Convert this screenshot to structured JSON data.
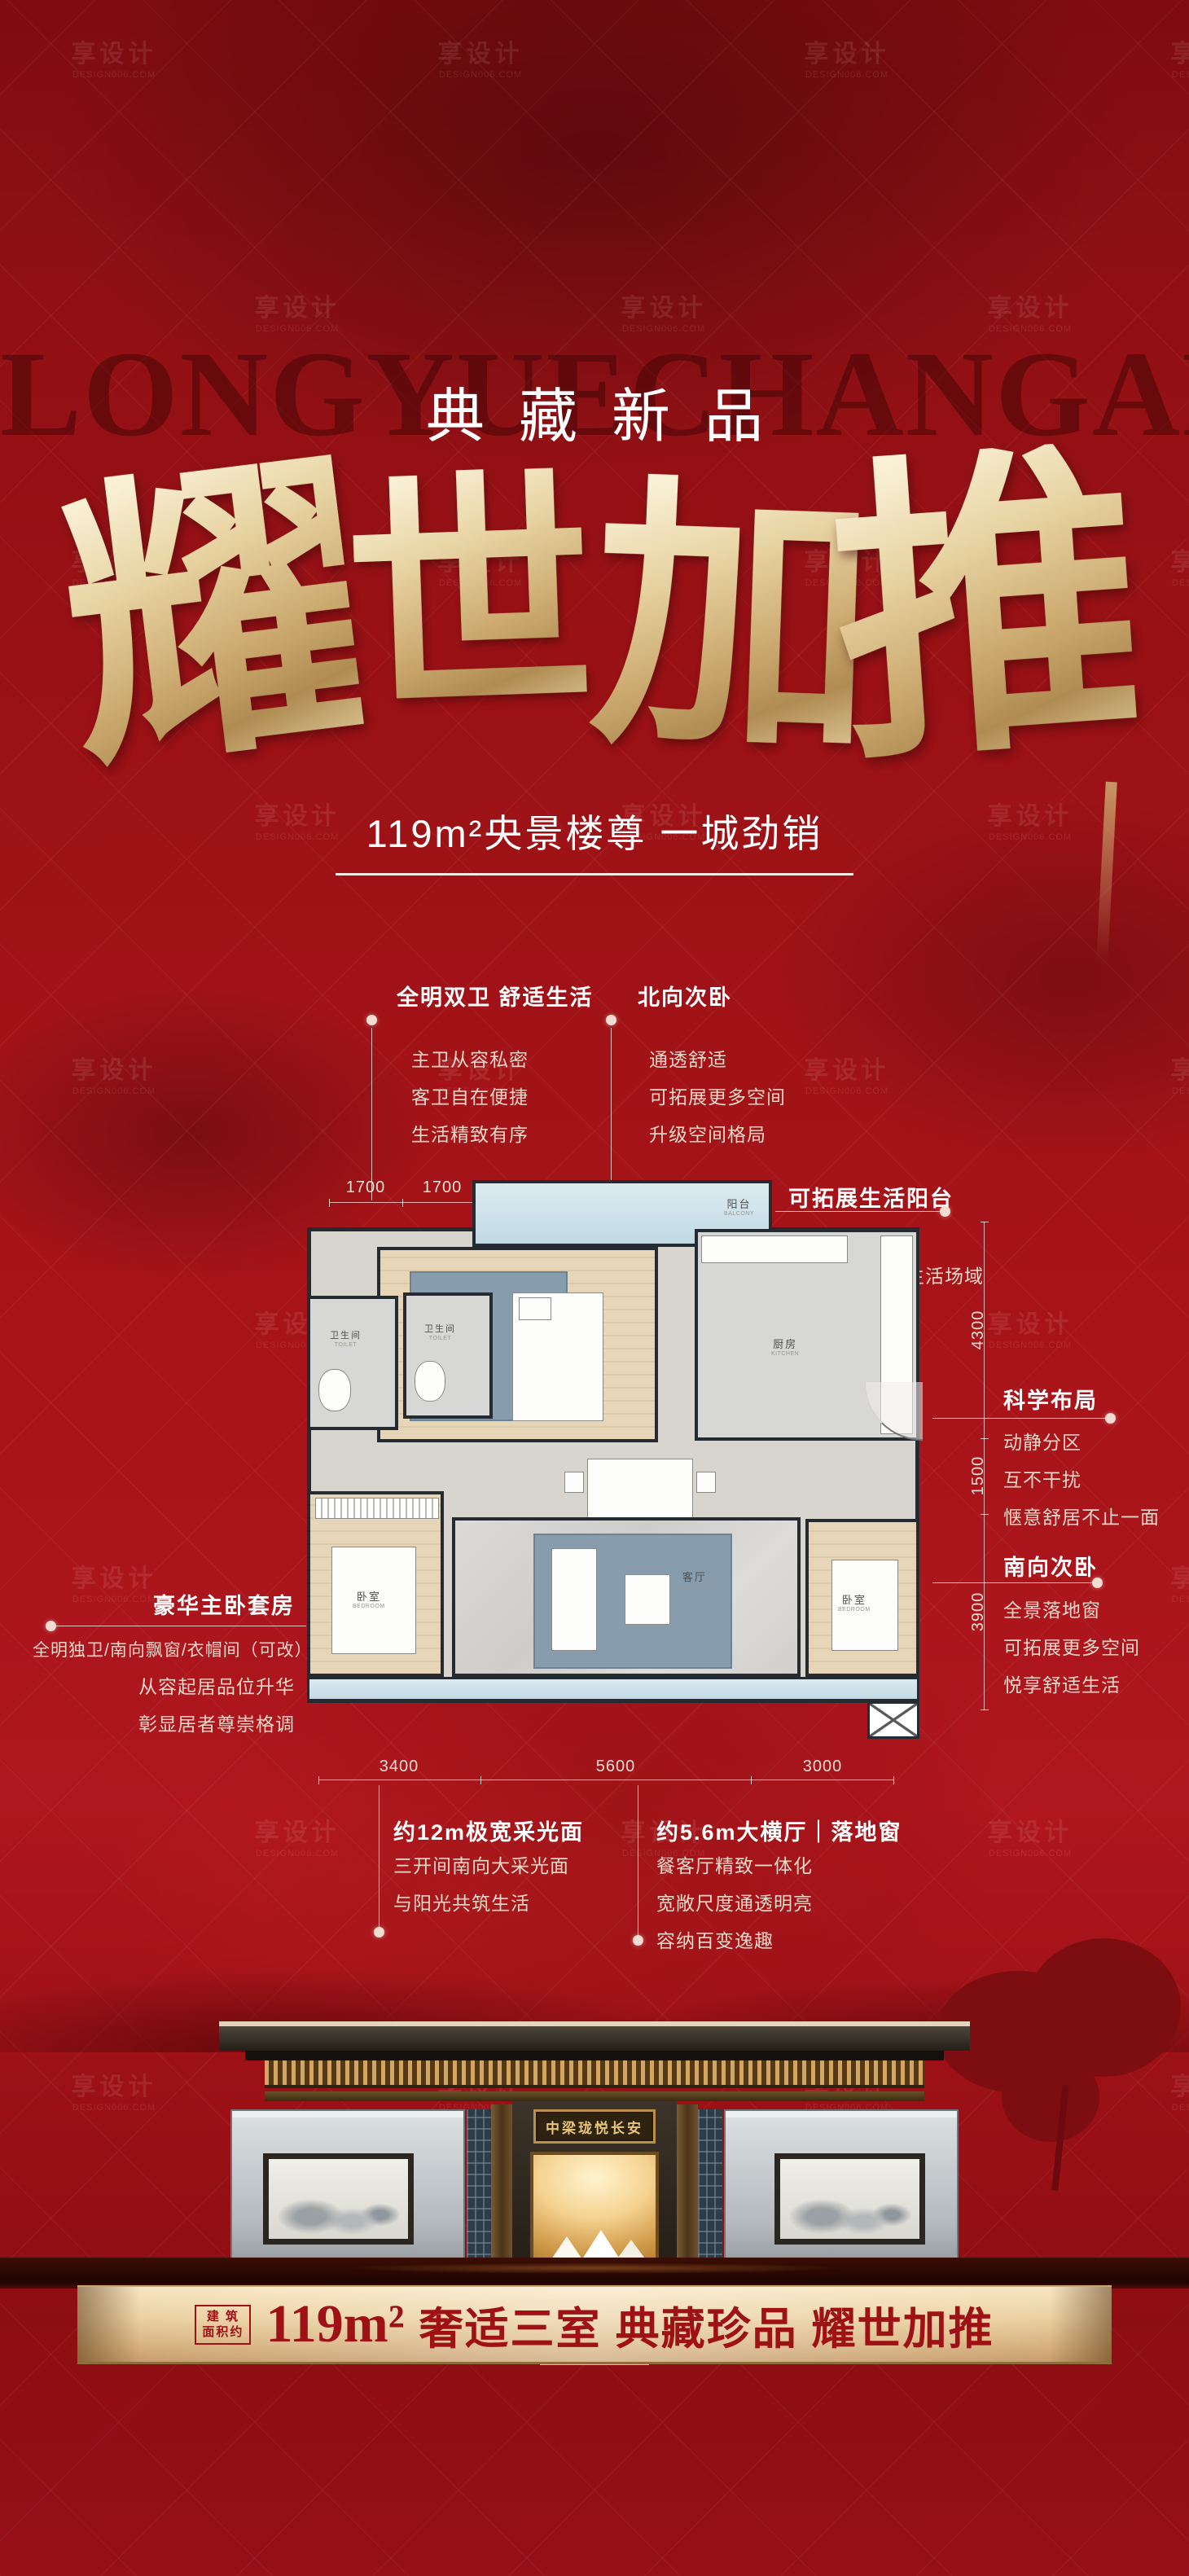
{
  "colors": {
    "background_red": "#9c1115",
    "gold_accent": "#d9bc8c",
    "banner_red_text": "#9e1115",
    "callout_body": "#eed7c8"
  },
  "watermark": {
    "brand": "享设计",
    "site": "DESIGN006.COM"
  },
  "backdrop_text": "LONGYUECHANGAN",
  "header": {
    "kicker": "典藏新品",
    "hero_chars": [
      "耀",
      "世",
      "加",
      "推"
    ],
    "subtitle": "119m²央景楼尊 一城劲销"
  },
  "floorplan": {
    "rooms": {
      "balcony": {
        "zh": "阳台",
        "en": "BALCONY"
      },
      "bedroom_north": {
        "zh": "卧室",
        "en": "BEDROOM"
      },
      "kitchen": {
        "zh": "厨房",
        "en": "KITCHEN"
      },
      "toilet1": {
        "zh": "卫生间",
        "en": "TOILET"
      },
      "toilet2": {
        "zh": "卫生间",
        "en": "TOILET"
      },
      "dining": {
        "zh": "餐厅",
        "en": "DINING ROOM"
      },
      "living": {
        "zh": "客厅",
        "en": "LIVING ROOM"
      },
      "bedroom_master": {
        "zh": "卧室",
        "en": "BEDROOM"
      },
      "bedroom_south": {
        "zh": "卧室",
        "en": "BEDROOM"
      }
    },
    "dims": {
      "top": [
        "1700",
        "1700",
        "3200",
        "2850"
      ],
      "right": [
        "4300",
        "1500",
        "3900"
      ],
      "bottom": [
        "3400",
        "5600",
        "3000"
      ]
    },
    "callouts": {
      "baths": {
        "title": "全明双卫 舒适生活",
        "lines": [
          "主卫从容私密",
          "客卫自在便捷",
          "生活精致有序"
        ]
      },
      "north_bedroom": {
        "title": "北向次卧",
        "lines": [
          "通透舒适",
          "可拓展更多空间",
          "升级空间格局"
        ]
      },
      "balcony": {
        "title": "可拓展生活阳台",
        "lines": [
          "拓展空间尺度",
          "容纳更多居家生活场域"
        ]
      },
      "layout": {
        "title": "科学布局",
        "lines": [
          "动静分区",
          "互不干扰",
          "惬意舒居不止一面"
        ]
      },
      "south_bedroom": {
        "title": "南向次卧",
        "lines": [
          "全景落地窗",
          "可拓展更多空间",
          "悦享舒适生活"
        ]
      },
      "master": {
        "title": "豪华主卧套房",
        "lines": [
          "全明独卫/南向飘窗/衣帽间（可改）",
          "从容起居品位升华",
          "彰显居者尊崇格调"
        ]
      },
      "daylight": {
        "title": "约12m极宽采光面",
        "lines": [
          "三开间南向大采光面",
          "与阳光共筑生活"
        ]
      },
      "hall": {
        "title": "约5.6m大横厅｜落地窗",
        "lines": [
          "餐客厅精致一体化",
          "宽敞尺度通透明亮",
          "容纳百变逸趣"
        ]
      }
    }
  },
  "building": {
    "plaque": "中梁珑悦长安"
  },
  "banner": {
    "prefix_top": "建 筑",
    "prefix_bottom": "面积约",
    "area": "119m²",
    "slogan": "奢适三室 典藏珍品 耀世加推"
  }
}
